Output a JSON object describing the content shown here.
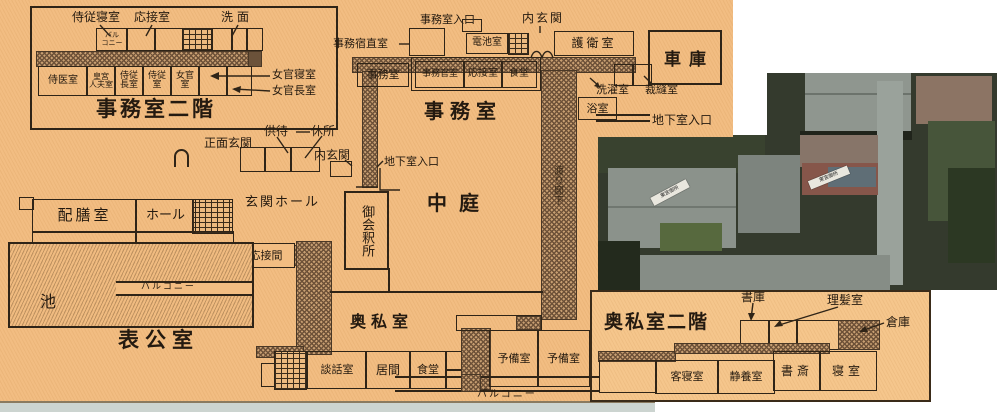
{
  "office2f": {
    "title": "事務室二階",
    "labels_top": {
      "chamberlain_bedroom": "侍従寝室",
      "reception": "応接室",
      "washroom": "洗面"
    },
    "balcony": "バル\nコニー",
    "rooms": [
      "侍医室",
      "皇宮\n人夫室",
      "侍従\n長室",
      "侍従\n室",
      "女官\n室"
    ],
    "labels_right": {
      "ladies_bedroom": "女官寝室",
      "chief_lady_room": "女官長室"
    }
  },
  "office1f": {
    "title": "事務室",
    "night_duty": "事務宿直室",
    "office_entrance": "事務室入口",
    "inner_entrance": "内玄関",
    "battery_room": "電池室",
    "guard_room": "護衛室",
    "office_small": "事務室",
    "officer_room": "事務官室",
    "reception": "応接室",
    "dining": "食堂",
    "laundry": "洗濯室",
    "sewing": "裁縫室",
    "bath": "浴室",
    "garage": "車庫",
    "basement_entrance": "地下室入口"
  },
  "main": {
    "attendants_wait": "供待",
    "rest_place": "休所",
    "main_entrance": "正面玄関",
    "inner_entrance": "内玄関",
    "basement_entrance": "地下室入口",
    "entrance_hall": "玄関ホール",
    "greeting_room": "御会釈所",
    "courtyard": "中庭",
    "corridor": "渡り廊下",
    "serving_room": "配膳室",
    "hall": "ホール",
    "grand_dining": "大食堂",
    "grand_reception": "大応接室",
    "reception_room": "応接間",
    "balcony": "バルコニー",
    "pond": "池",
    "public_rooms": "表公室"
  },
  "private1f": {
    "title": "奥私室",
    "talk_room": "談話室",
    "living_room": "居間",
    "dining": "食堂",
    "spare1": "予備室",
    "spare2": "予備室",
    "balcony": "バルコニー"
  },
  "private2f": {
    "title": "奥私室二階",
    "book_storage": "書庫",
    "barber_room": "理髪室",
    "warehouse": "倉庫",
    "guest_bedroom": "客寝室",
    "rest_room": "静養室",
    "study": "書斎",
    "bedroom": "寝室"
  },
  "photo": {
    "tag1": "東宮御所",
    "tag2": "東宮御所"
  }
}
